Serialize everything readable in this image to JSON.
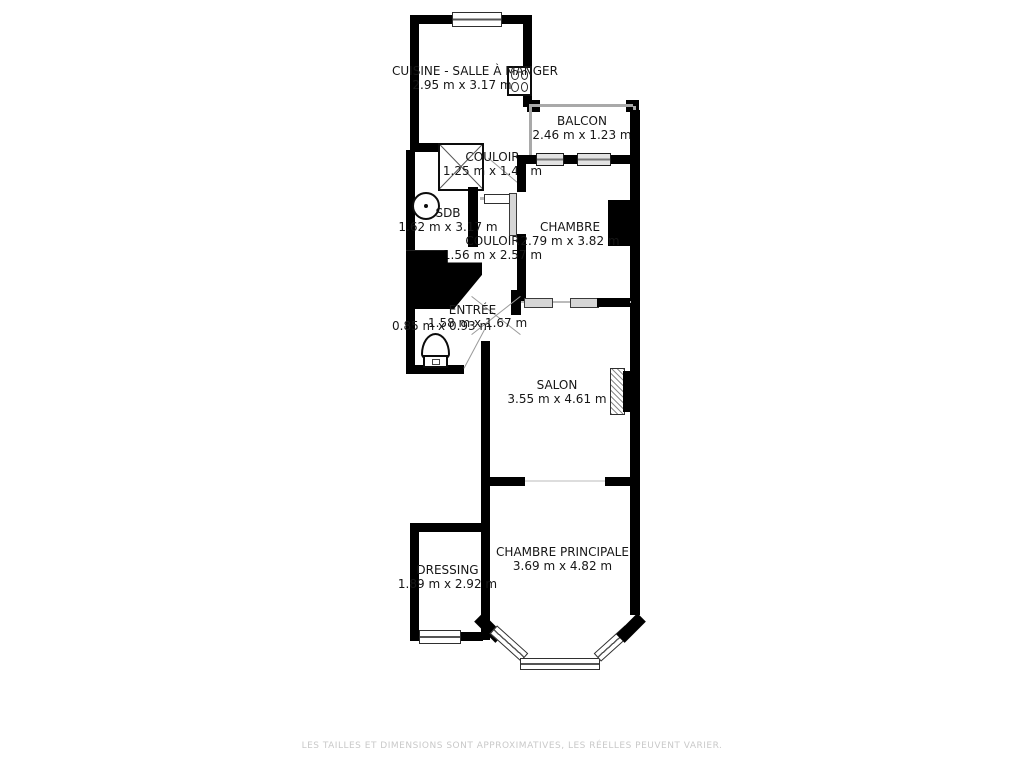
{
  "rooms": {
    "cuisine": {
      "name": "CUISINE - SALLE À MANGER",
      "dims": "2.95 m x 3.17 m"
    },
    "balcon": {
      "name": "BALCON",
      "dims": "2.46 m x 1.23 m"
    },
    "couloir1": {
      "name": "COULOIR",
      "dims": "1.25 m x 1.42 m"
    },
    "sdb": {
      "name": "SDB",
      "dims": "1.62 m x 3.17 m"
    },
    "chambre": {
      "name": "CHAMBRE",
      "dims": "2.79 m x 3.82 m"
    },
    "couloir2": {
      "name": "COULOIR",
      "dims": "1.56 m x 2.57 m"
    },
    "entree": {
      "name": "ENTRÉE",
      "dims": "1.58 m x 1.67 m"
    },
    "wc": {
      "dims": "0.85 m x 0.93 m"
    },
    "salon": {
      "name": "SALON",
      "dims": "3.55 m x 4.61 m"
    },
    "dressing": {
      "name": "DRESSING",
      "dims": "1.89 m x 2.92 m"
    },
    "chambre_principale": {
      "name": "CHAMBRE PRINCIPALE",
      "dims": "3.69 m x 4.82 m"
    }
  },
  "icons": {
    "shower": "shower-icon",
    "sink": "sink-icon",
    "toilet": "toilet-icon",
    "stove": "stove-icon",
    "fireplace": "fireplace-icon"
  },
  "colors": {
    "wall": "#000000",
    "background": "#ffffff",
    "disclaimer_text": "#c9c9c9"
  },
  "footer": {
    "disclaimer": "LES TAILLES ET DIMENSIONS SONT APPROXIMATIVES, LES RÉELLES PEUVENT VARIER."
  }
}
